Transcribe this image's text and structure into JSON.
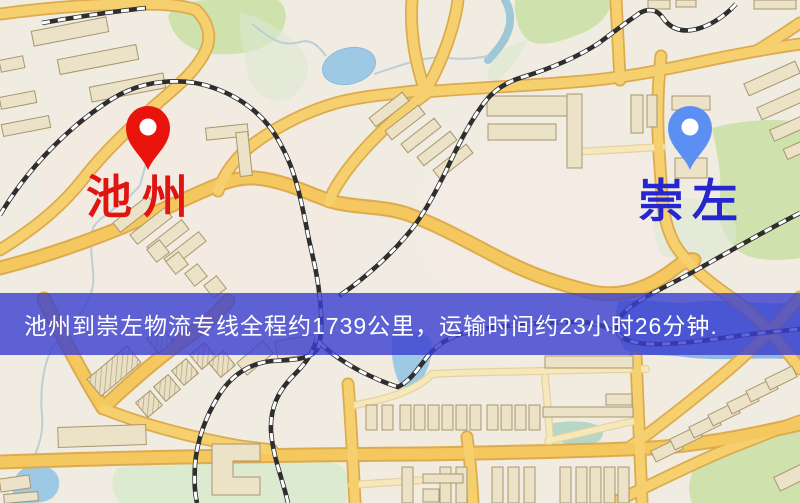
{
  "map": {
    "origin_marker": {
      "label": "池州",
      "pin_color": "#e8130a",
      "label_color": "#e01511"
    },
    "destination_marker": {
      "label": "崇左",
      "pin_color": "#5b8ff2",
      "label_color": "#2526cf"
    },
    "banner": {
      "text": "池州到崇左物流专线全程约1739公里，运输时间约23小时26分钟.",
      "distance_km": 1739,
      "duration_text": "23小时26分钟",
      "background_color": "#3a3ed0",
      "text_color": "#ffffff"
    },
    "palette": {
      "background": "#f1ece1",
      "road_fill": "#f6d06e",
      "road_casing": "#dcab4e",
      "minor_road": "#f7e8bb",
      "railway": "#2e2e2e",
      "building": "#ebe2c8",
      "park": "#cfe2ad",
      "water": "#9dc9e4"
    }
  }
}
